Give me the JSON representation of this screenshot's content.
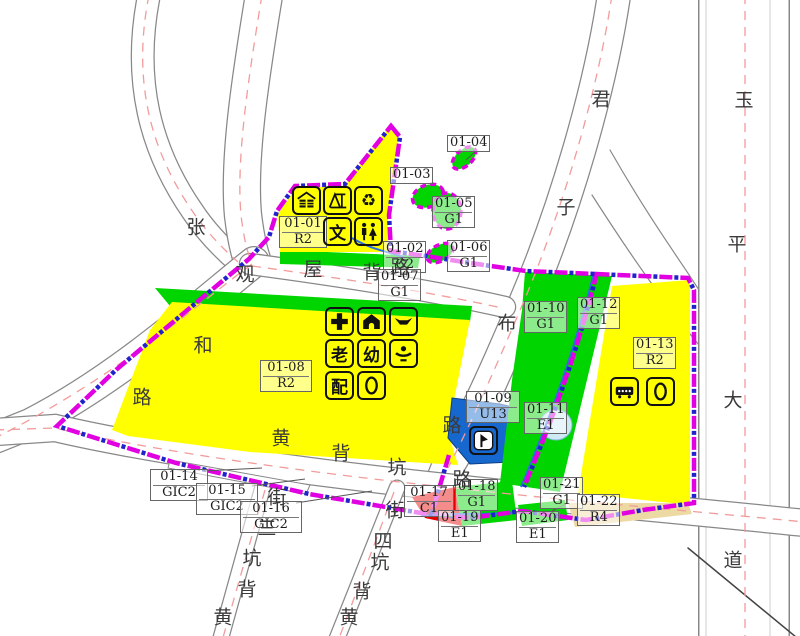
{
  "map": {
    "colors": {
      "residential_r2": "#ffff00",
      "residential_r4": "#edd9a3",
      "green_space": "#00d500",
      "utility_u13": "#1668cf",
      "commercial_c1": "#e60000",
      "water": "#cfe9f5",
      "boundary_magenta": "#e100e1",
      "boundary_blue": "#2222cc",
      "road_centerline_pink": "#f29b9b"
    },
    "parcels": [
      {
        "id": "01-01",
        "use": "R2"
      },
      {
        "id": "01-02",
        "use": "G2"
      },
      {
        "id": "01-03",
        "use": ""
      },
      {
        "id": "01-04",
        "use": ""
      },
      {
        "id": "01-05",
        "use": "G1"
      },
      {
        "id": "01-06",
        "use": "G1"
      },
      {
        "id": "01-07",
        "use": "G1"
      },
      {
        "id": "01-08",
        "use": "R2"
      },
      {
        "id": "01-09",
        "use": "U13"
      },
      {
        "id": "01-10",
        "use": "G1"
      },
      {
        "id": "01-11",
        "use": "E1"
      },
      {
        "id": "01-12",
        "use": "G1"
      },
      {
        "id": "01-13",
        "use": "R2"
      },
      {
        "id": "01-14",
        "use": "GIC2"
      },
      {
        "id": "01-15",
        "use": "GIC2"
      },
      {
        "id": "01-16",
        "use": "GIC2"
      },
      {
        "id": "01-17",
        "use": "C1"
      },
      {
        "id": "01-18",
        "use": "G1"
      },
      {
        "id": "01-19",
        "use": "E1"
      },
      {
        "id": "01-20",
        "use": "E1"
      },
      {
        "id": "01-21",
        "use": "G1"
      },
      {
        "id": "01-22",
        "use": "R4"
      }
    ],
    "roads": [
      {
        "name": "zhang-guan-he-road",
        "chars": [
          "张",
          "观",
          "和",
          "路"
        ]
      },
      {
        "name": "wu-bei-road",
        "chars": [
          "屋",
          "背",
          "路"
        ]
      },
      {
        "name": "huang-bei-keng-road",
        "chars": [
          "黄",
          "背",
          "坑",
          "路"
        ]
      },
      {
        "name": "jun-zi-bu-road",
        "chars": [
          "君",
          "子",
          "布",
          "路"
        ]
      },
      {
        "name": "yu-ping-avenue",
        "chars": [
          "玉",
          "平",
          "大",
          "道"
        ]
      },
      {
        "name": "huang-bei-keng-3rd-street",
        "chars": [
          "街",
          "三",
          "坑",
          "背",
          "黄"
        ]
      },
      {
        "name": "huang-bei-keng-4th-street",
        "chars": [
          "街",
          "四",
          "坑",
          "背",
          "黄"
        ]
      }
    ],
    "icons": {
      "glyph_map": {
        "culture-icon": "文",
        "elderly-care-icon": "老",
        "kindergarten-icon": "幼",
        "power-distribution-icon": "配",
        "recycle-icon": "♻"
      },
      "groups": [
        {
          "parcel": "01-01",
          "items": [
            "market-icon",
            "structure-icon",
            "recycle-icon",
            "culture-icon",
            "toilet-icon"
          ]
        },
        {
          "parcel": "01-08",
          "items": [
            "clinic-icon",
            "community-house-icon",
            "culture-activity-icon",
            "elderly-care-icon",
            "kindergarten-icon",
            "rehab-icon",
            "power-distribution-icon",
            "postal-icon"
          ]
        },
        {
          "parcel": "01-13",
          "items": [
            "bus-stop-icon",
            "postal-icon"
          ]
        },
        {
          "parcel": "01-09",
          "items": [
            "substation-icon"
          ]
        }
      ]
    }
  }
}
